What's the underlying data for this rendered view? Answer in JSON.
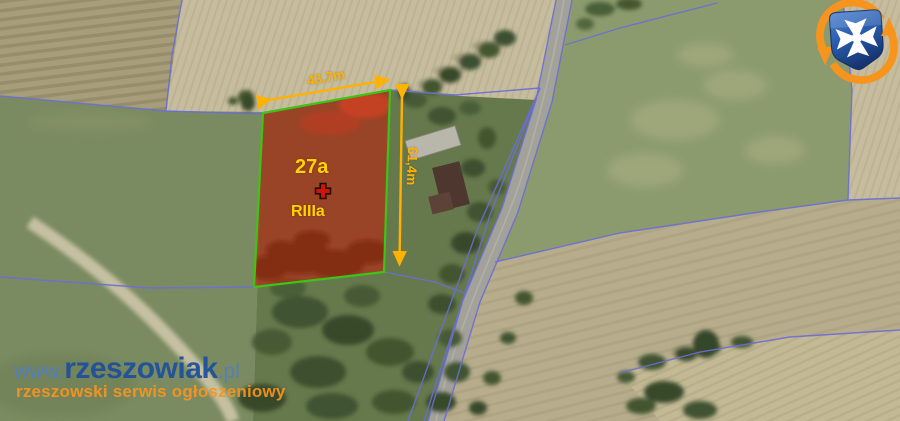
{
  "annotation": {
    "area_label": "27a",
    "soil_class_label": "RIIIa",
    "width_label": "43.7m",
    "height_label": "61,4m"
  },
  "watermark": {
    "url_prefix": "www.",
    "site_name": "rzeszowiak",
    "url_tld": ".pl",
    "tagline": "rzeszowski serwis ogłoszeniowy"
  },
  "colors": {
    "plot_fill": "#bf1e0c",
    "plot_fill_opacity": "0.58",
    "plot_border": "#3ec414",
    "dimension_orange": "#ffb200",
    "label_yellow": "#ffd400",
    "parcel_line_blue": "#6a6ed6",
    "marker_red": "#cf1408",
    "marker_outline": "#1c0c00",
    "watermark_light_blue": "#4f7fc4",
    "watermark_navy": "#1d4f9e",
    "watermark_orange": "#f8951e",
    "logo_orange": "#f7941d",
    "logo_shield_blue": "#2a5cac"
  }
}
